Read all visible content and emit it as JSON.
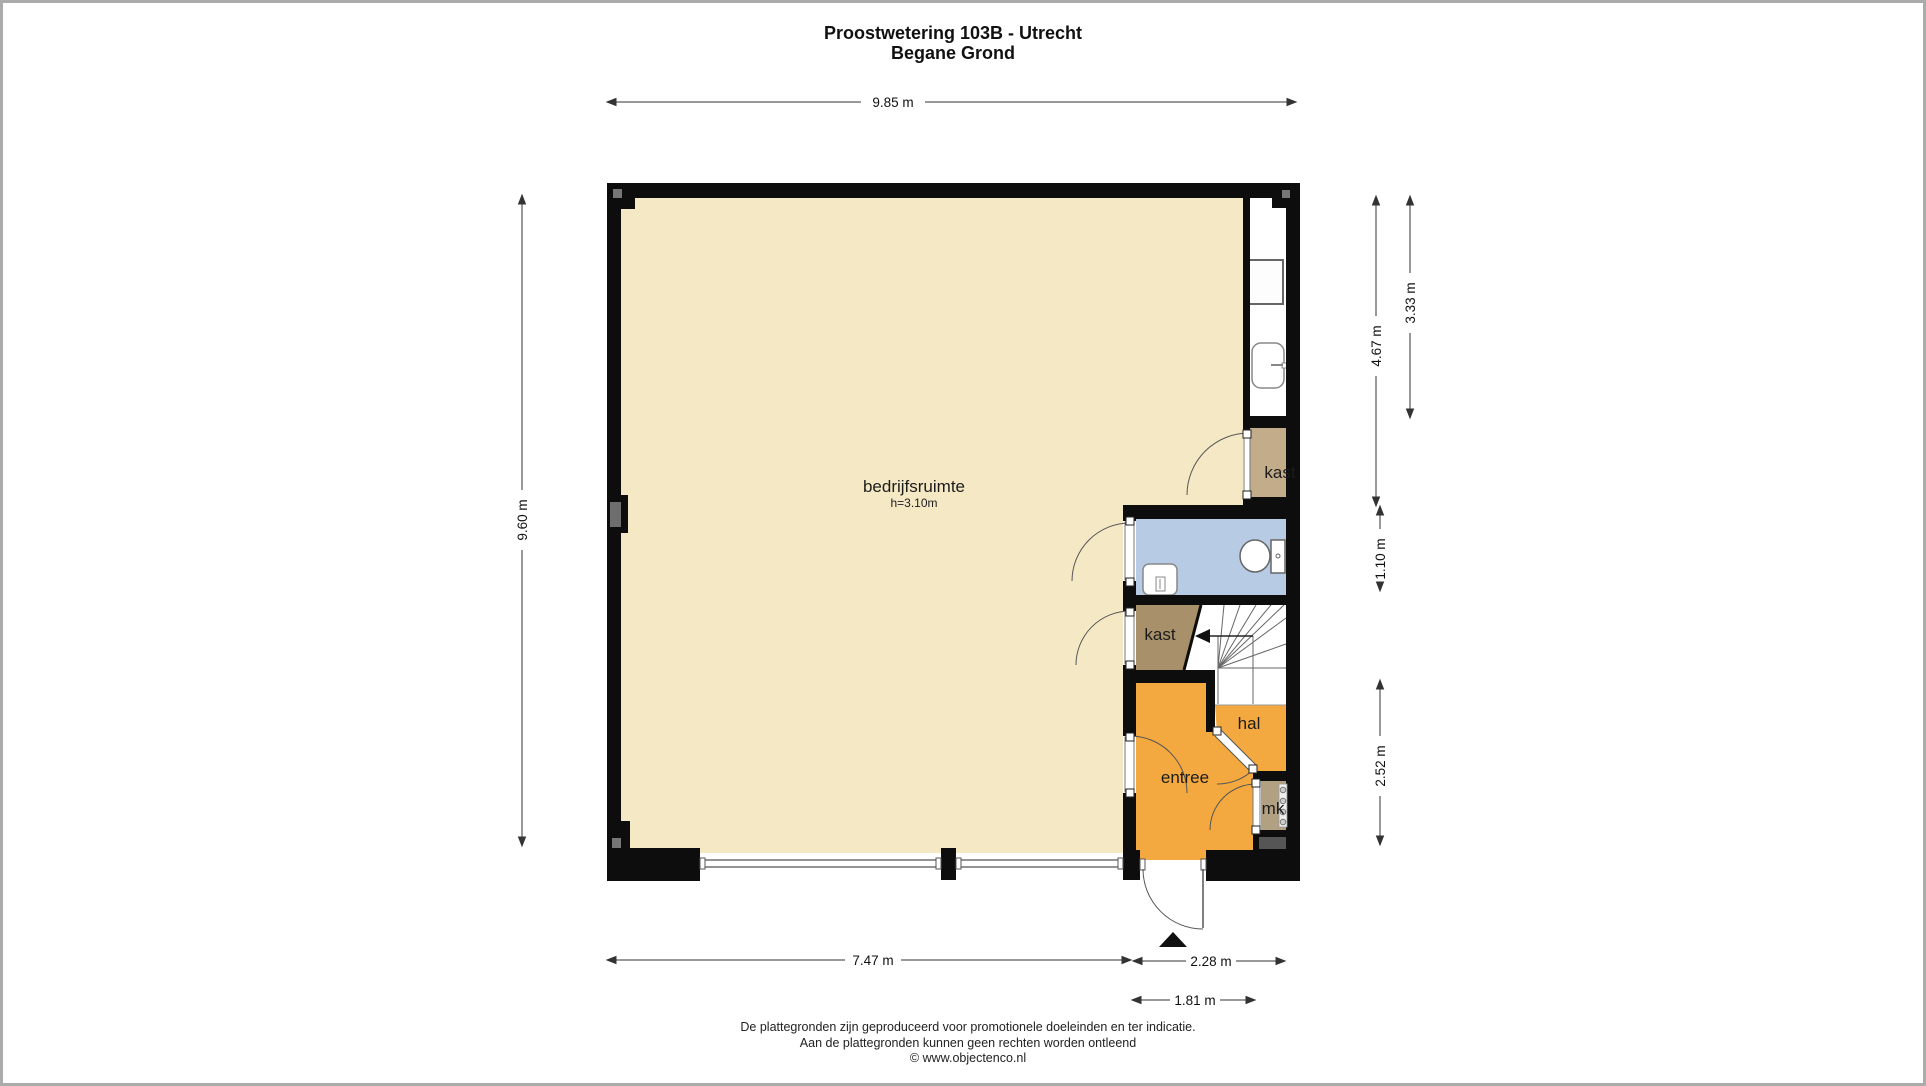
{
  "title": {
    "address": "Proostwetering 103B - Utrecht",
    "floor": "Begane Grond"
  },
  "rooms": {
    "bedrijfsruimte": {
      "label": "bedrijfsruimte",
      "height": "h=3.10m"
    },
    "kast_upper": {
      "label": "kast"
    },
    "kast_lower": {
      "label": "kast"
    },
    "hal": {
      "label": "hal"
    },
    "entree": {
      "label": "entree"
    },
    "mk": {
      "label": "mk"
    }
  },
  "dimensions": {
    "top_width": "9.85 m",
    "left_height": "9.60 m",
    "right_inner": "4.67 m",
    "right_outer": "3.33 m",
    "right_toilet": "1.10 m",
    "right_lower": "2.52 m",
    "bottom_main": "7.47 m",
    "bottom_right": "2.28 m",
    "bottom_door": "1.81 m"
  },
  "footer": {
    "line1": "De plattegronden zijn geproduceerd voor promotionele doeleinden en ter indicatie.",
    "line2": "Aan de plattegronden kunnen geen rechten worden ontleend",
    "line3": "© www.objectenco.nl"
  },
  "colors": {
    "floor_cream": "#F5E9C5",
    "room_orange": "#F3A93F",
    "toilet_blue": "#B7CBE4",
    "closet_light_brown": "#C2AC8A",
    "closet_brown": "#A8906B",
    "mk_taupe": "#B2A083",
    "wall_black": "#0d0d0d"
  }
}
